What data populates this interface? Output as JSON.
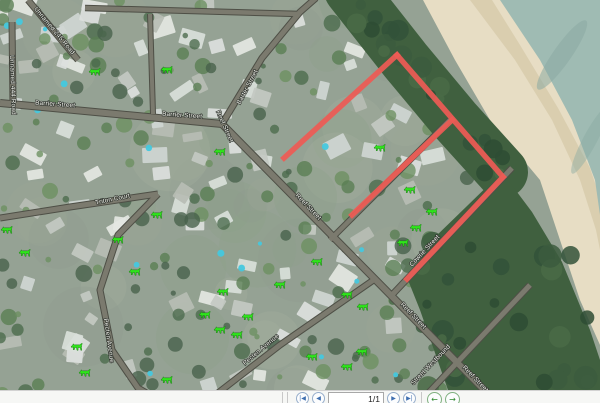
{
  "map": {
    "streets": [
      {
        "name": "Unnamed 245 Road",
        "x": 53,
        "y": 32,
        "rot": 50
      },
      {
        "name": "Unnamed 444 Road",
        "x": 11,
        "y": 85,
        "rot": 88
      },
      {
        "name": "Barrier Street",
        "x": 55,
        "y": 106,
        "rot": 4
      },
      {
        "name": "Barrier Street",
        "x": 182,
        "y": 117,
        "rot": 4
      },
      {
        "name": "Barter Street",
        "x": 249,
        "y": 88,
        "rot": -62
      },
      {
        "name": "Reef Street",
        "x": 223,
        "y": 127,
        "rot": 66
      },
      {
        "name": "Reef Street",
        "x": 307,
        "y": 208,
        "rot": 46
      },
      {
        "name": "Reef Street",
        "x": 412,
        "y": 317,
        "rot": 46
      },
      {
        "name": "Reef Street",
        "x": 474,
        "y": 380,
        "rot": 46
      },
      {
        "name": "Cowrie Street",
        "x": 426,
        "y": 252,
        "rot": -47
      },
      {
        "name": "Street Westbound",
        "x": 432,
        "y": 366,
        "rot": -46
      },
      {
        "name": "Triton Court",
        "x": 113,
        "y": 201,
        "rot": -12
      },
      {
        "name": "Pecten Avenue",
        "x": 107,
        "y": 341,
        "rot": 82
      },
      {
        "name": "Pecten Avenue",
        "x": 262,
        "y": 351,
        "rot": -40
      }
    ],
    "route_color": "#ee5b55",
    "route_segments": [
      [
        284,
        158,
        397,
        55
      ],
      [
        397,
        55,
        503,
        177
      ],
      [
        503,
        177,
        407,
        279
      ],
      [
        452,
        120,
        352,
        215
      ]
    ],
    "marker_color": "#2fe41b",
    "markers": [
      [
        95,
        72
      ],
      [
        167,
        70
      ],
      [
        220,
        152
      ],
      [
        380,
        148
      ],
      [
        410,
        190
      ],
      [
        432,
        212
      ],
      [
        416,
        228
      ],
      [
        403,
        243
      ],
      [
        317,
        262
      ],
      [
        347,
        295
      ],
      [
        363,
        307
      ],
      [
        312,
        357
      ],
      [
        347,
        367
      ],
      [
        362,
        352
      ],
      [
        7,
        230
      ],
      [
        25,
        253
      ],
      [
        157,
        215
      ],
      [
        118,
        240
      ],
      [
        135,
        272
      ],
      [
        77,
        347
      ],
      [
        85,
        373
      ],
      [
        167,
        380
      ],
      [
        223,
        292
      ],
      [
        205,
        315
      ],
      [
        220,
        330
      ],
      [
        237,
        335
      ],
      [
        248,
        317
      ],
      [
        280,
        285
      ]
    ]
  },
  "pager": {
    "first": "|◀",
    "prev": "◀",
    "page": "1/1",
    "next": "▶",
    "last": "▶|",
    "back": "←",
    "forward": "→"
  }
}
